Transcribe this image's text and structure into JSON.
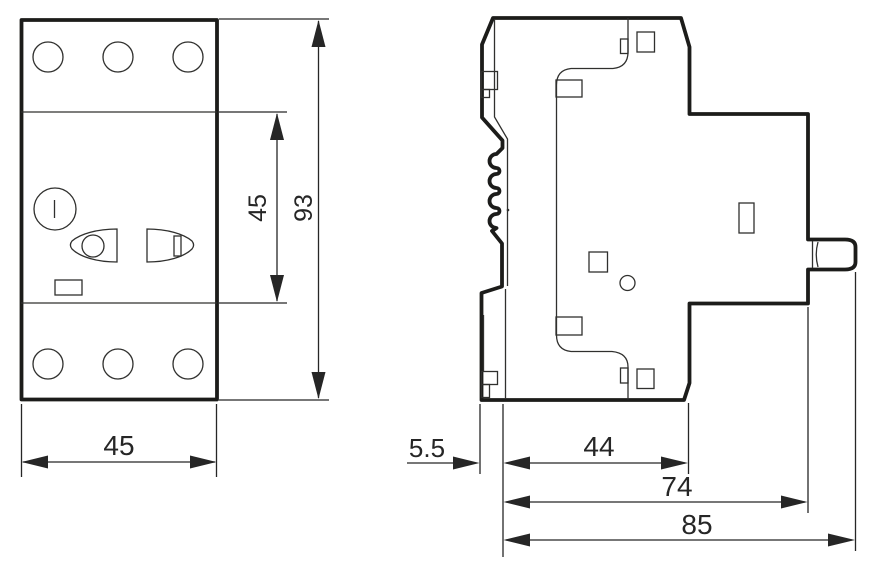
{
  "front_view": {
    "width_label": "45",
    "section_height_label": "45",
    "height_label": "93"
  },
  "side_view": {
    "clip_depth_label": "5.5",
    "front_depth_label": "44",
    "body_depth_label": "74",
    "total_depth_label": "85"
  },
  "colors": {
    "body_fill": "#dbeadb",
    "outline": "#1c1c1a",
    "dimension": "#262626",
    "background": "#ffffff"
  }
}
